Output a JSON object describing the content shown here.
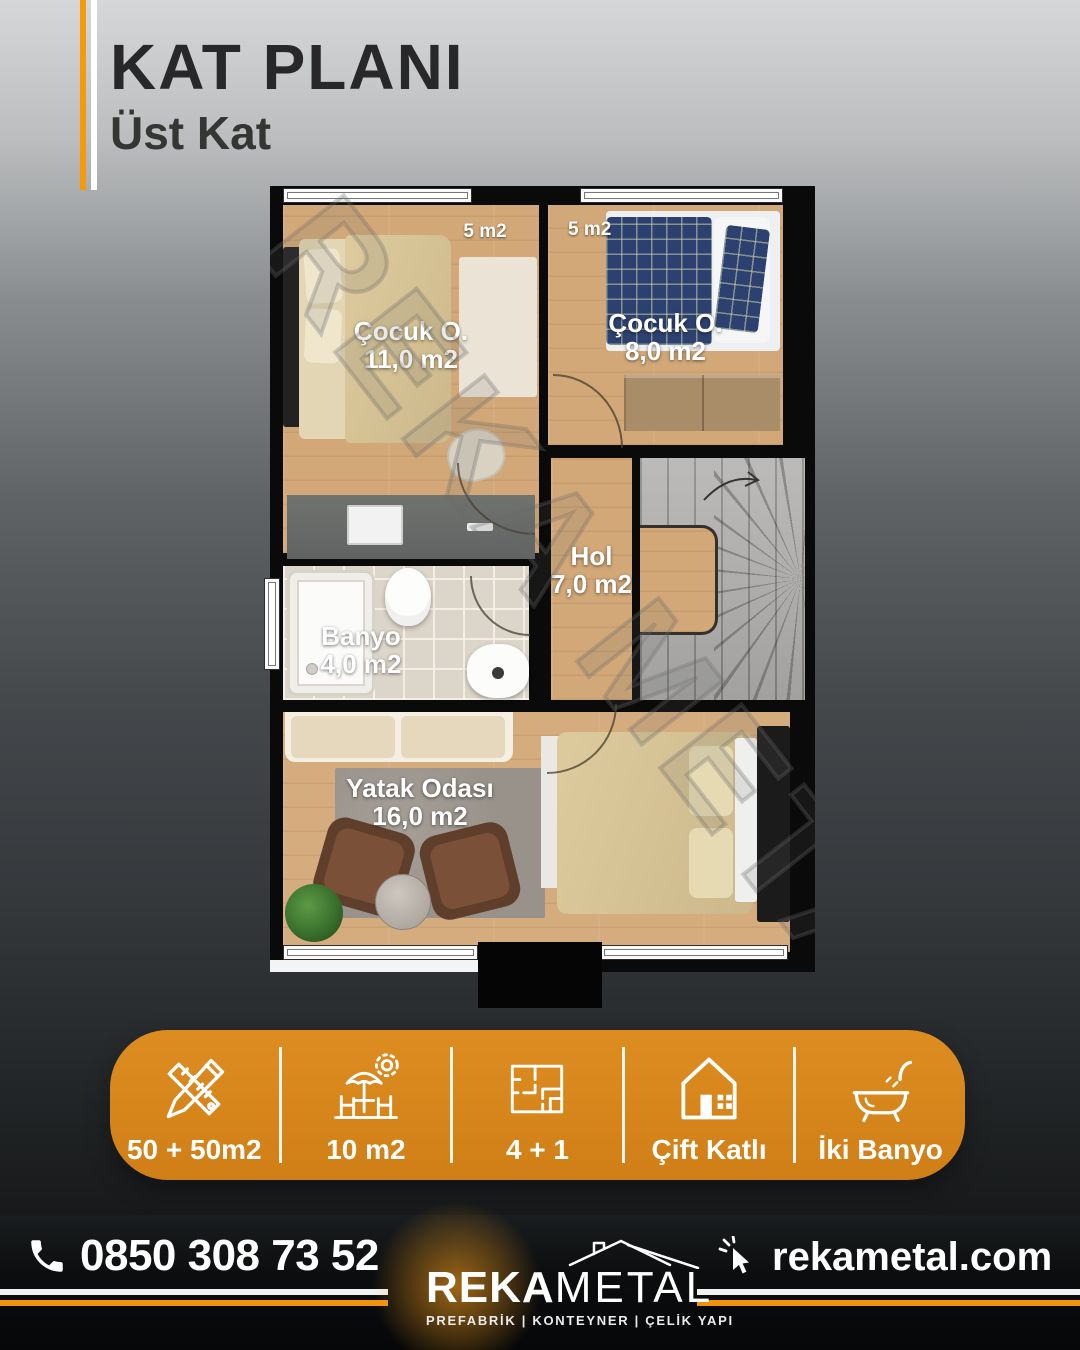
{
  "header": {
    "title": "KAT PLANI",
    "subtitle": "Üst Kat"
  },
  "floor_plan": {
    "watermark": "REKA METAL",
    "balcony_labels": [
      "5 m2",
      "5 m2"
    ],
    "rooms": [
      {
        "name": "Çocuk O.",
        "area": "11,0 m2"
      },
      {
        "name": "Çocuk O.",
        "area": "8,0 m2"
      },
      {
        "name": "Hol",
        "area": "7,0 m2"
      },
      {
        "name": "Banyo",
        "area": "4,0 m2"
      },
      {
        "name": "Yatak Odası",
        "area": "16,0 m2"
      }
    ]
  },
  "features": {
    "bar_color": "#d8861c",
    "items": [
      {
        "icon": "ruler-pencil-icon",
        "label": "50 + 50m2"
      },
      {
        "icon": "terrace-umbrella-icon",
        "label": "10 m2"
      },
      {
        "icon": "floorplan-icon",
        "label": "4 + 1"
      },
      {
        "icon": "house-icon",
        "label": "Çift Katlı"
      },
      {
        "icon": "bathtub-icon",
        "label": "İki Banyo"
      }
    ]
  },
  "footer": {
    "accent_color": "#f0930b",
    "phone_icon": "phone-icon",
    "phone": "0850 308 73 52",
    "website_icon": "cursor-click-icon",
    "website": "rekametal.com",
    "brand": {
      "name_bold": "REKA",
      "name_light": "METAL",
      "roof_icon": "roof-icon",
      "tagline": "PREFABRİK | KONTEYNER | ÇELİK YAPI"
    }
  }
}
